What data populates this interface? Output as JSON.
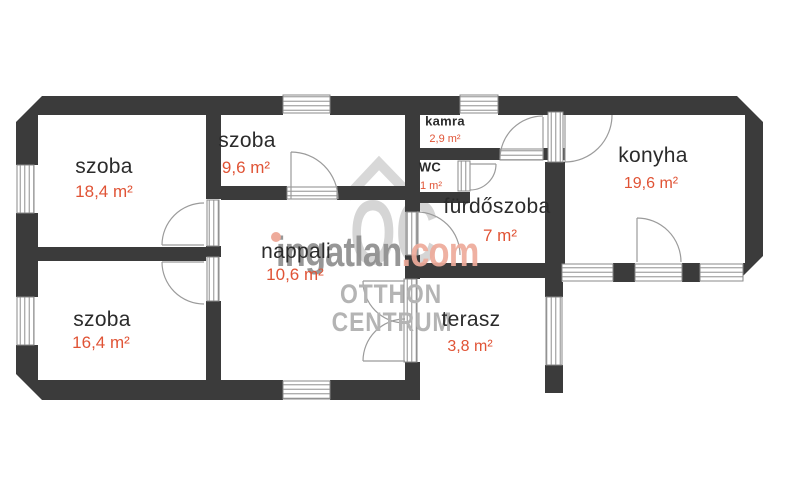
{
  "floorplan": {
    "rooms": [
      {
        "id": "szoba-1",
        "name": "szoba",
        "area": "18,4 m²"
      },
      {
        "id": "szoba-2",
        "name": "szoba",
        "area": "9,6 m²"
      },
      {
        "id": "nappali",
        "name": "nappali",
        "area": "10,6 m²"
      },
      {
        "id": "kamra",
        "name": "kamra",
        "area": "2,9 m²"
      },
      {
        "id": "wc",
        "name": "WC",
        "area": "1 m²"
      },
      {
        "id": "furdoszoba",
        "name": "fürdőszoba",
        "area": "7 m²"
      },
      {
        "id": "konyha",
        "name": "konyha",
        "area": "19,6 m²"
      },
      {
        "id": "szoba-3",
        "name": "szoba",
        "area": "16,4 m²"
      },
      {
        "id": "terasz",
        "name": "terasz",
        "area": "3,8 m²"
      }
    ],
    "colors": {
      "wall": "#3b3b3b",
      "room_name_text": "#2b2b2b",
      "area_text": "#e05335",
      "watermark_gray": "#8f8f8f",
      "watermark_salmon": "#eeab9b"
    }
  },
  "watermark": {
    "logo_text": "OC",
    "brand_gray": "ingatlan",
    "brand_accent": ".com",
    "line1": "OTTHON",
    "line2": "CENTRUM"
  }
}
